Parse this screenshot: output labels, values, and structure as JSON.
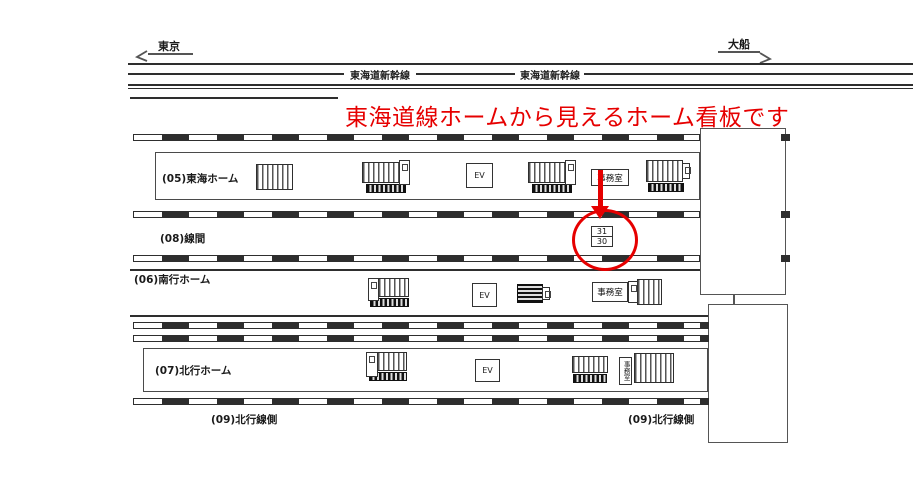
{
  "annotation": {
    "note_text": "東海道線ホームから見えるホーム看板です"
  },
  "directions": {
    "left_label": "東京",
    "right_label": "大船"
  },
  "lines": {
    "shinkansen_label": "東海道新幹線"
  },
  "platforms": {
    "p05_label": "(05)東海ホーム",
    "p08_label": "(08)線間",
    "p06_label": "(06)南行ホーム",
    "p07_label": "(07)北行ホーム",
    "p09_label": "(09)北行線側"
  },
  "facilities": {
    "elevator_label": "EV",
    "office_label": "事務室"
  },
  "highlighted_sign": {
    "top_number": "31",
    "bottom_number": "30"
  },
  "colors": {
    "annotation_red": "#e60000",
    "line_dark": "#2e2e2e"
  }
}
